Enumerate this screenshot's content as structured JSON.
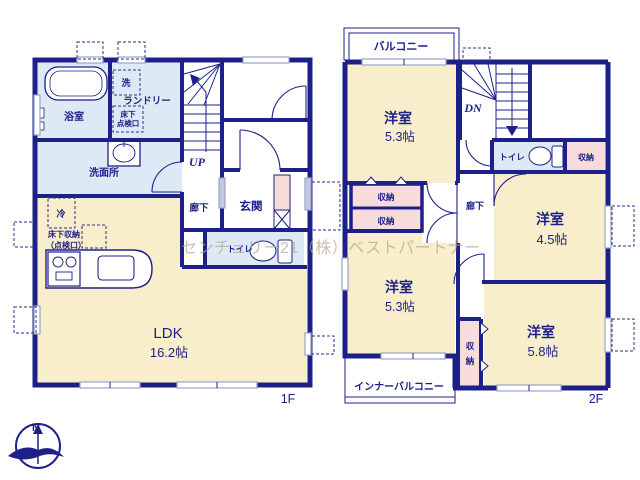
{
  "watermark": "センチュリー21（株）ベストパートナー",
  "compass": {
    "north": "N"
  },
  "colors": {
    "wall": "#1d2088",
    "room_cream": "#f9eecb",
    "wet_blue": "#dde9f5",
    "closet_pink": "#f8dcdb"
  },
  "f1": {
    "label": "1F",
    "bath": "浴室",
    "laundry": "ランドリー",
    "washroom": "洗面所",
    "entrance": "玄関",
    "hall": "廊下",
    "toilet": "トイレ",
    "ldk": "LDK",
    "ldk_size": "16.2帖",
    "up": "UP",
    "washer": "洗",
    "fridge": "冷",
    "uf_access_l1": "床下",
    "uf_access_l2": "点検口",
    "uf_storage_l1": "床下収納",
    "uf_storage_l2": "（点検口）"
  },
  "f2": {
    "label": "2F",
    "balcony": "バルコニー",
    "inner_balcony": "インナーバルコニー",
    "dn": "DN",
    "toilet": "トイレ",
    "hall": "廊下",
    "room_n": "洋室",
    "room_n_size": "5.3帖",
    "room_e": "洋室",
    "room_e_size": "4.5帖",
    "room_sw": "洋室",
    "room_sw_size": "5.3帖",
    "room_se": "洋室",
    "room_se_size": "5.8帖",
    "closet_ne": "収納",
    "closet_a": "収納",
    "closet_b": "収納",
    "closet_v1": "収",
    "closet_v2": "納"
  }
}
